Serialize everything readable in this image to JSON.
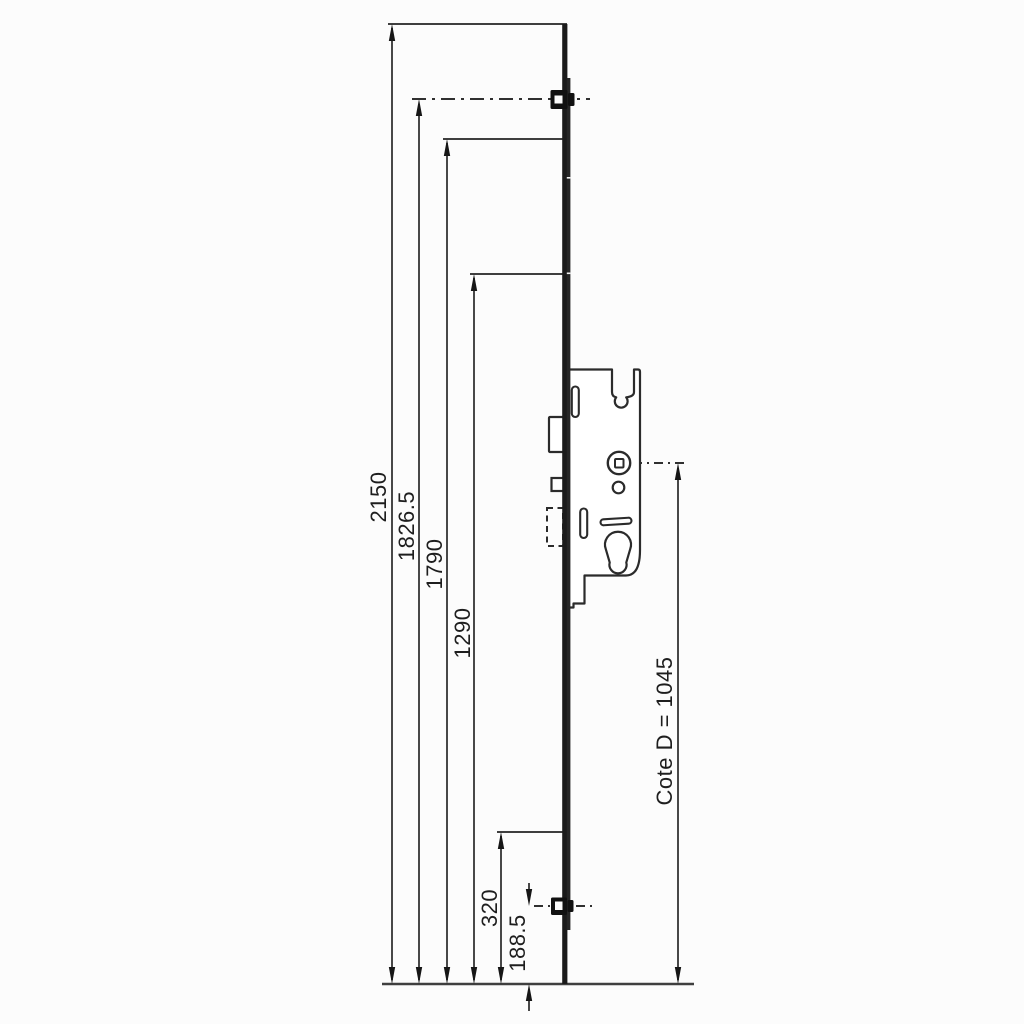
{
  "drawing": {
    "type": "technical-dimension-drawing",
    "subject": "Multipoint door lock espagnolette with centre gearbox and roller cams"
  },
  "colors": {
    "background": "#fcfcfc",
    "dimension_line": "#3f3f3f",
    "arrow_ink": "#161616",
    "outline": "#2b2b2b",
    "rail_fill": "#1b1b1b",
    "text": "#1e1e1e"
  },
  "dimensions": [
    {
      "name": "overall-height",
      "label": "2150"
    },
    {
      "name": "top-roller-centre",
      "label": "1826.5"
    },
    {
      "name": "rail-upper-point",
      "label": "1790"
    },
    {
      "name": "rail-mid-point",
      "label": "1290"
    },
    {
      "name": "lower-point",
      "label": "320"
    },
    {
      "name": "bottom-roller-centre",
      "label": "188.5"
    },
    {
      "name": "handle-centre-height",
      "label": "Cote D = 1045"
    }
  ]
}
